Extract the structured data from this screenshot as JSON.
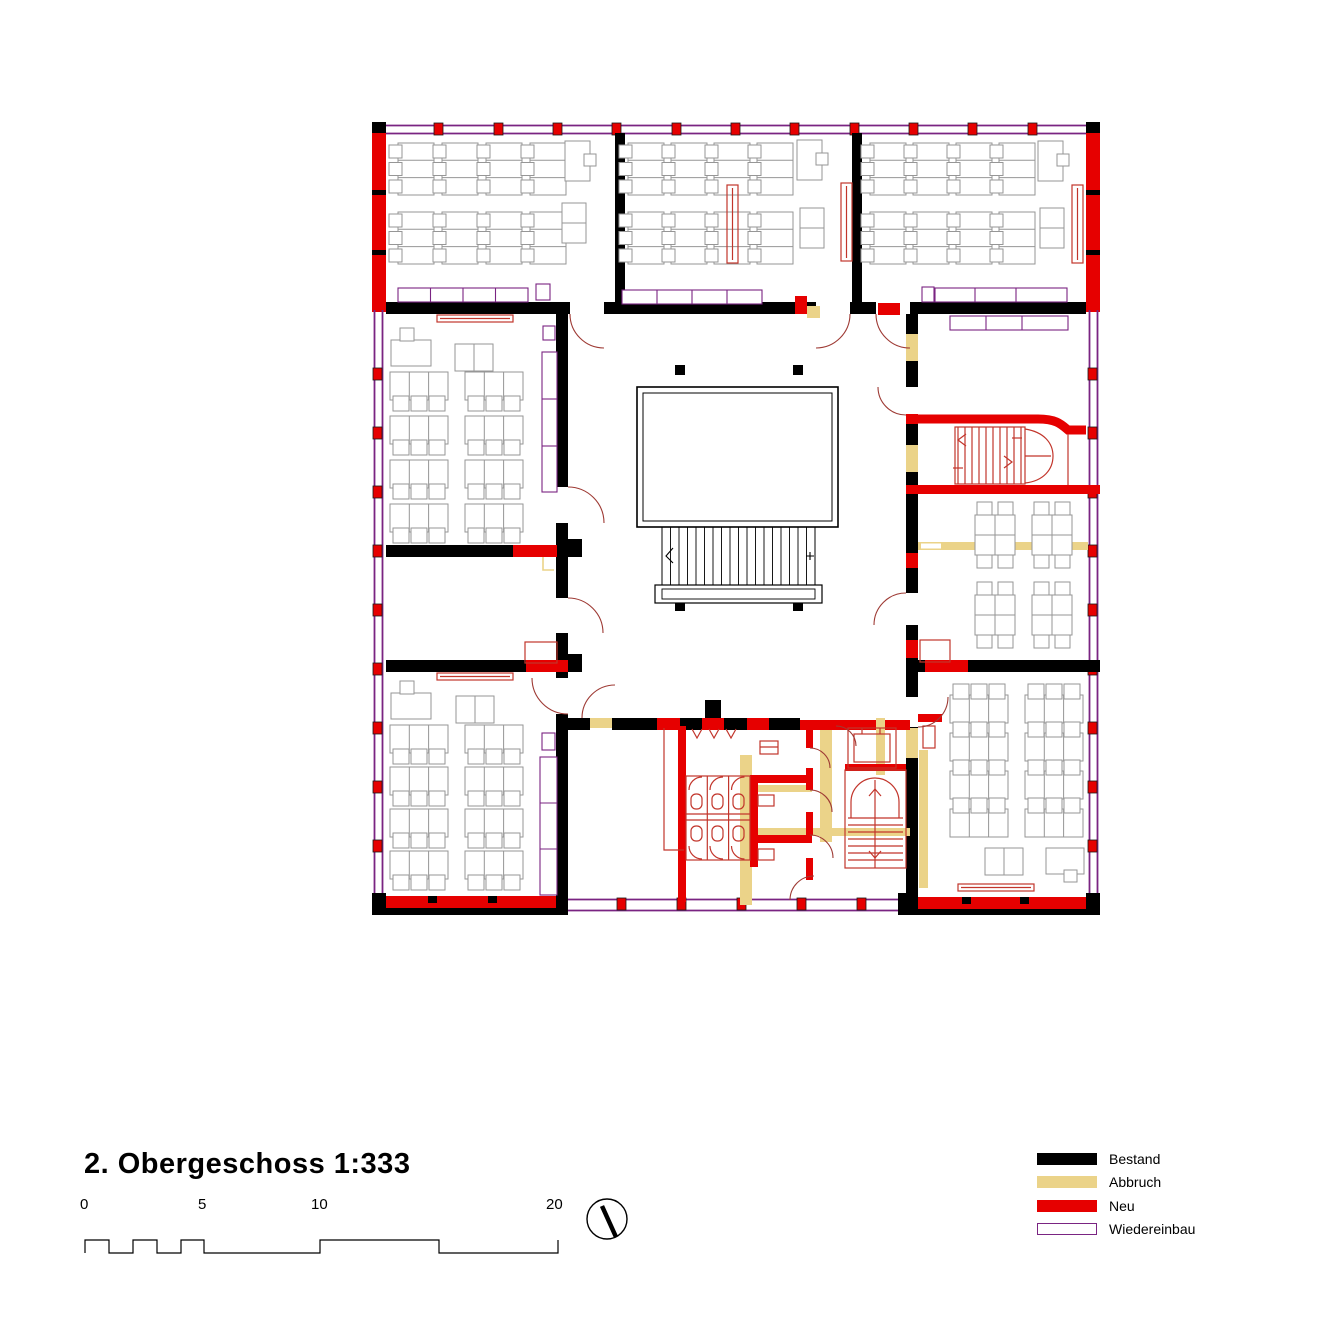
{
  "title": "2. Obergeschoss 1:333",
  "scale_bar": {
    "tick_labels": [
      "0",
      "5",
      "10",
      "20"
    ]
  },
  "legend": {
    "items": [
      {
        "label": "Bestand",
        "color": "#000000",
        "style": "fill"
      },
      {
        "label": "Abbruch",
        "color": "#ebd389",
        "style": "fill"
      },
      {
        "label": "Neu",
        "color": "#e60000",
        "style": "fill"
      },
      {
        "label": "Wiedereinbau",
        "color": "#7a2482",
        "style": "outline"
      }
    ]
  },
  "colors": {
    "bestand": "#000000",
    "abbruch": "#ebd389",
    "neu": "#e60000",
    "wiedereinbau": "#7a2482",
    "furniture": "#969696",
    "fixture": "#c2352b",
    "door_arc": "#9e3a34"
  }
}
